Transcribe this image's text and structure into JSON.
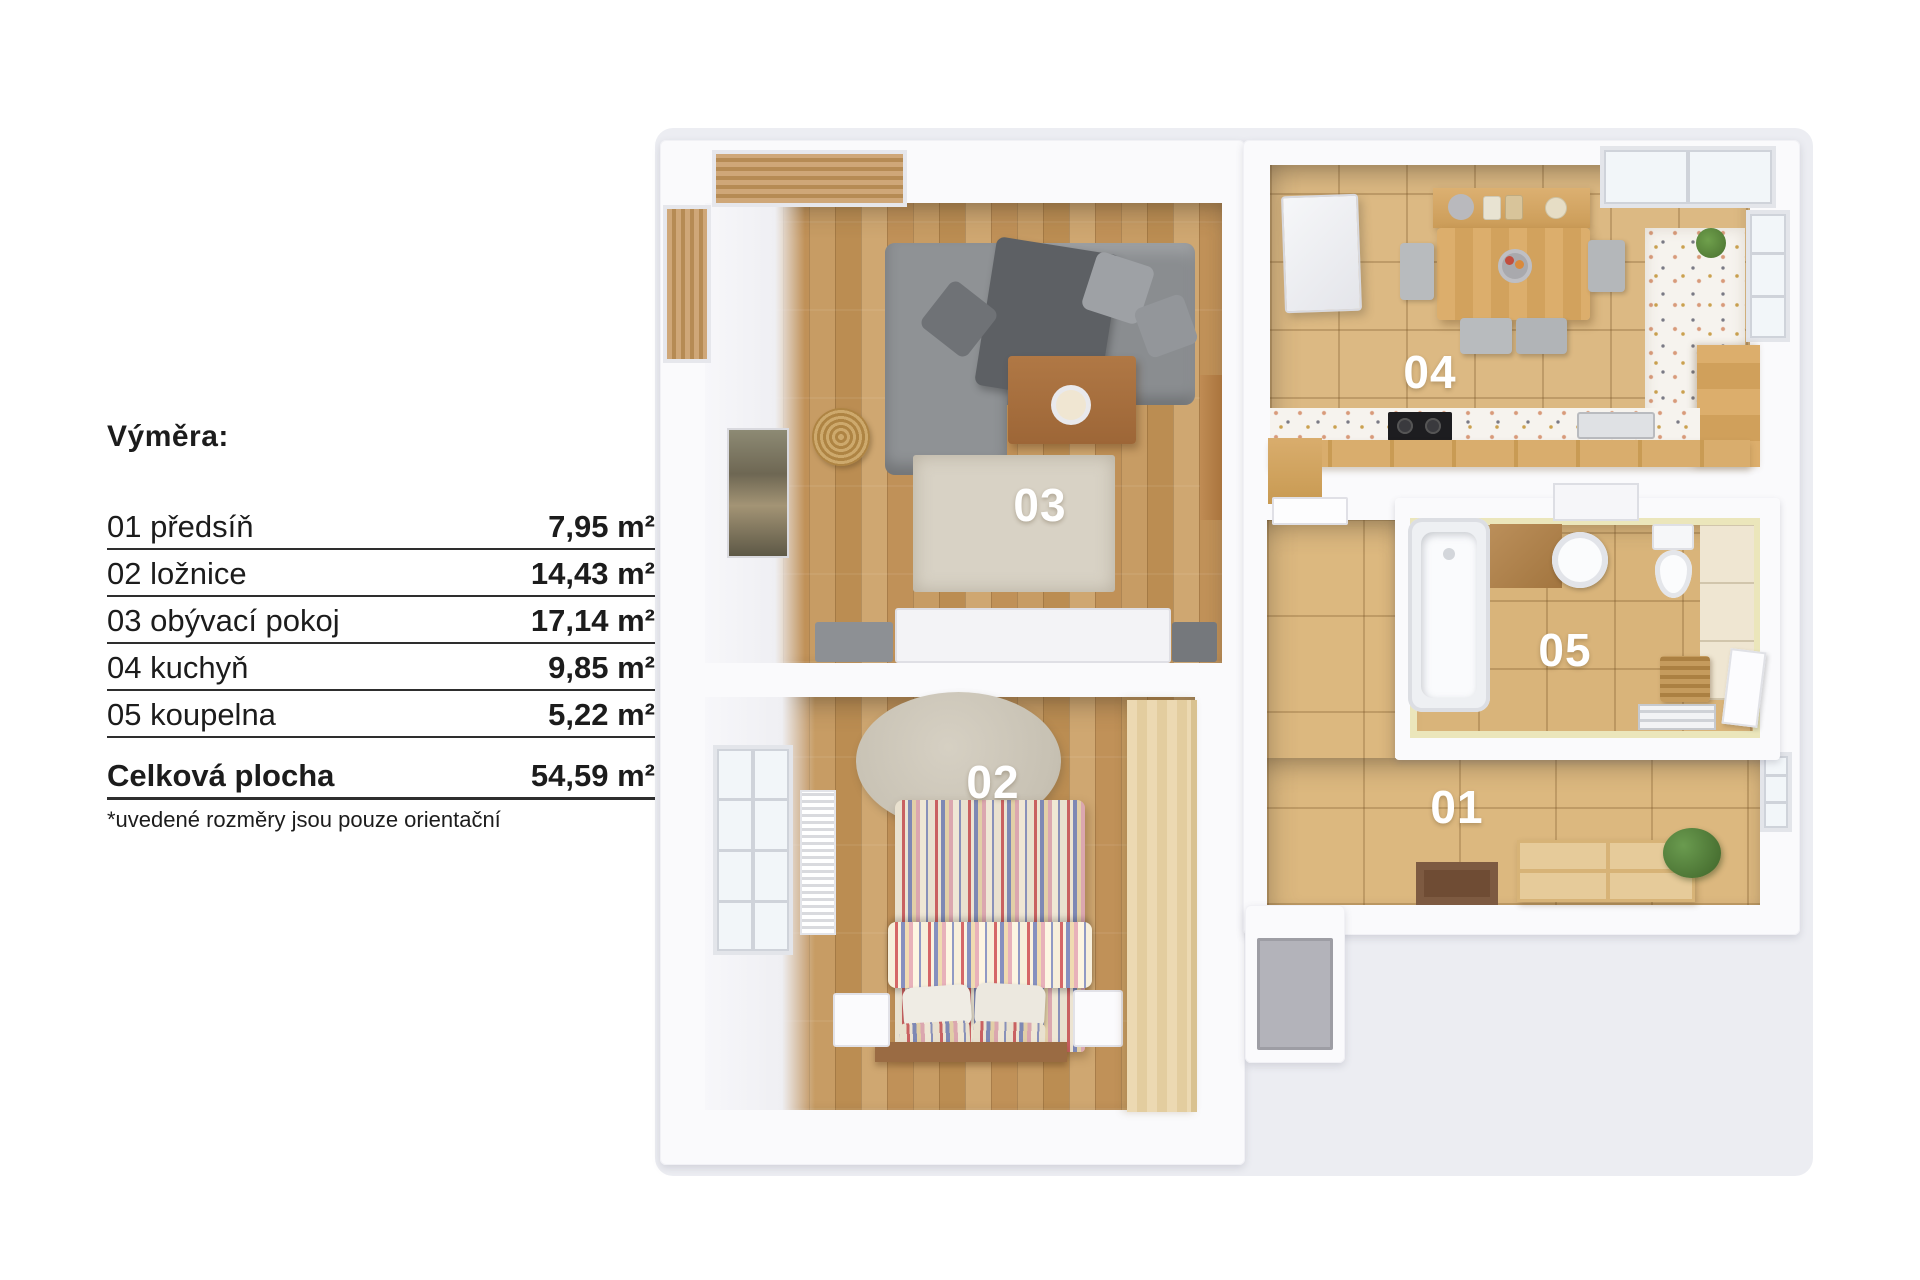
{
  "legend": {
    "title": "Výměra:",
    "rows": [
      {
        "label": "01 předsíň",
        "value": "7,95 m²"
      },
      {
        "label": "02 ložnice",
        "value": "14,43 m²"
      },
      {
        "label": "03 obývací pokoj",
        "value": "17,14 m²"
      },
      {
        "label": "04 kuchyň",
        "value": "9,85 m²"
      },
      {
        "label": "05 koupelna",
        "value": "5,22 m²"
      }
    ],
    "total": {
      "label": "Celková plocha",
      "value": "54,59 m²"
    },
    "footnote": "*uvedené rozměry jsou pouze orientační"
  },
  "floorplan": {
    "labels": {
      "living": "03",
      "bedroom": "02",
      "kitchen": "04",
      "bathroom": "05",
      "hallway": "01"
    }
  },
  "colors": {
    "background": "#ffffff",
    "plan_backdrop": "#ecedf2",
    "walls": "#fafafc",
    "wood_floor": "#c79c64",
    "tile_floor": "#dcb983",
    "rug": "#d8d2c5",
    "sofa_gray": "#8a8d90",
    "bath_accent_yellow": "#ebe6bb",
    "room_label_text": "#ffffff",
    "legend_text": "#1c1c1c"
  }
}
